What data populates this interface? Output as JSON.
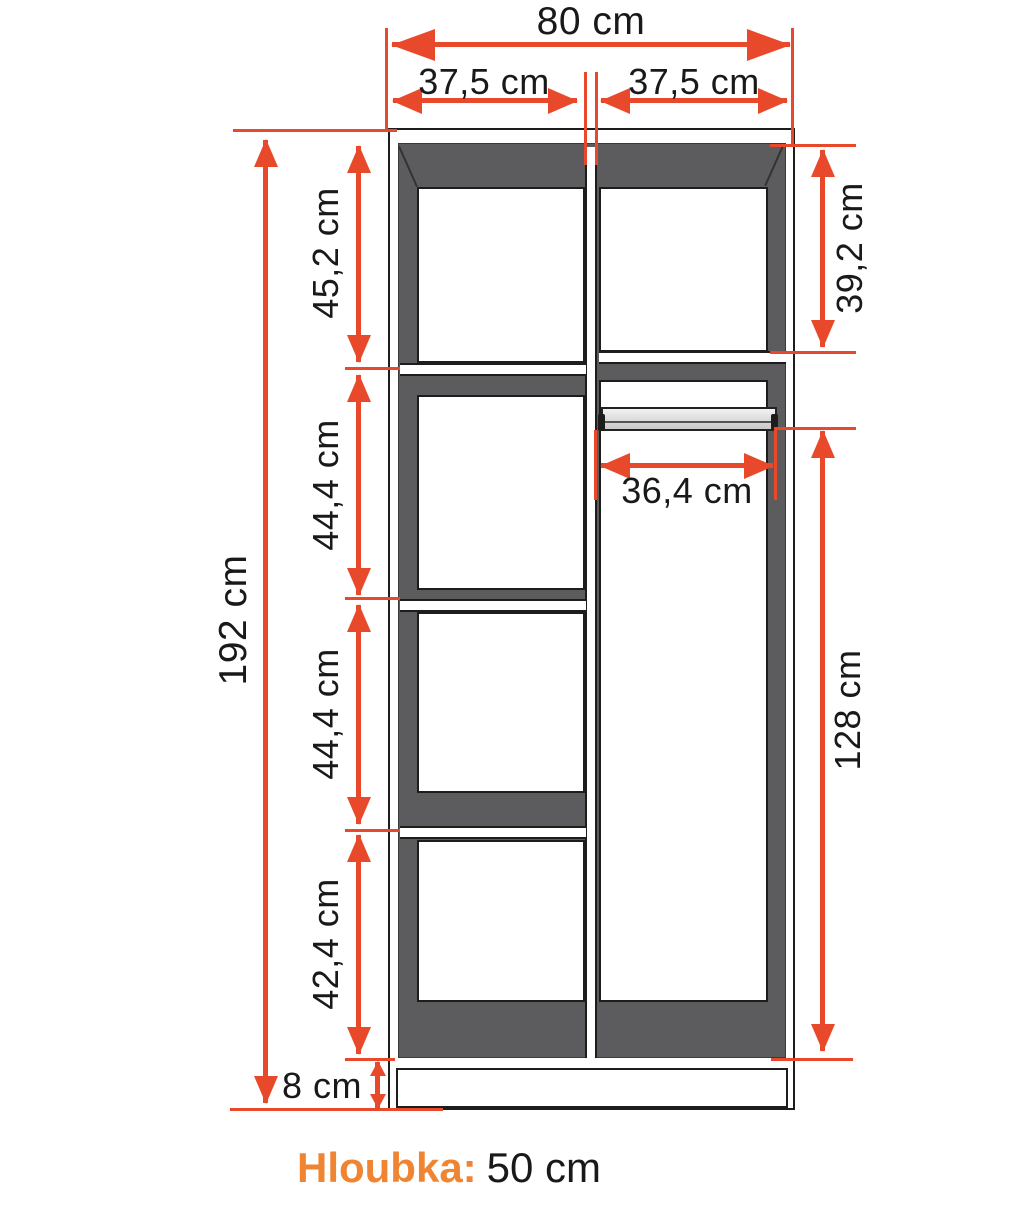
{
  "title": "Wardrobe dimension diagram",
  "dimensions": {
    "total_width": "80 cm",
    "left_half_width": "37,5 cm",
    "right_half_width": "37,5 cm",
    "total_height": "192 cm",
    "left_section_1": "45,2 cm",
    "left_section_2": "44,4 cm",
    "left_section_3": "44,4 cm",
    "left_section_4": "42,4 cm",
    "right_top_section": "39,2 cm",
    "rail_width": "36,4 cm",
    "hanging_section_height": "128 cm",
    "plinth_height": "8 cm"
  },
  "footer": {
    "depth_label": "Hloubka:",
    "depth_value": "50 cm"
  },
  "colors": {
    "dim_red": "#e8492b",
    "accent_orange": "#ef8532",
    "cab_gray": "#5c5c5e",
    "outline": "#1d1d1b",
    "rail_gray": "#d9d9d9",
    "text_black": "#191919"
  }
}
